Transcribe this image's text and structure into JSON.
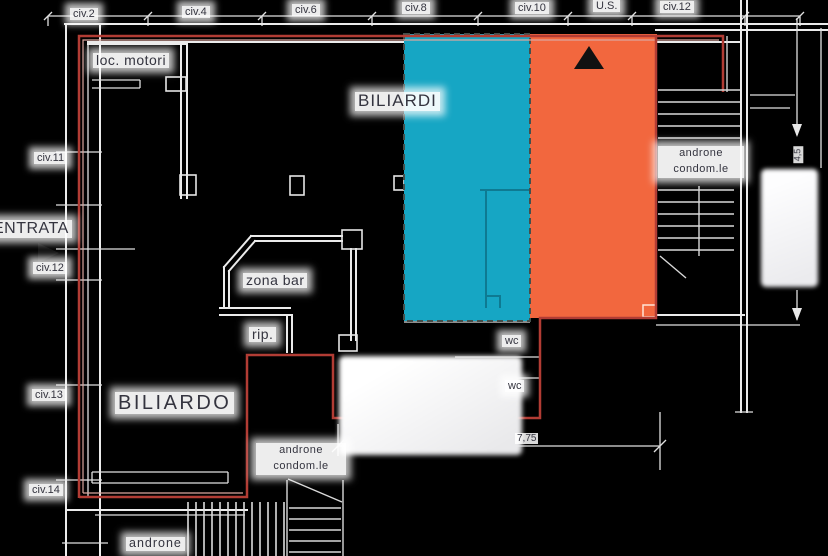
{
  "canvas": {
    "width": 828,
    "height": 556,
    "background": "#000000"
  },
  "colors": {
    "teal": "#16a6c4",
    "orange": "#f2673e",
    "outline_red": "#b23c34",
    "plan_line": "#ebebeb",
    "label_text": "#34343f",
    "label_halo": "#ffffff"
  },
  "labels": {
    "civ2": "civ.2",
    "civ4": "civ.4",
    "civ6": "civ.6",
    "civ8": "civ.8",
    "civ10": "civ.10",
    "us": "U.S.",
    "civ12_top": "civ.12",
    "civ11": "civ.11",
    "entrata": "ENTRATA",
    "civ12_left": "civ.12",
    "civ13": "civ.13",
    "civ14": "civ.14",
    "loc_motori": "loc. motori",
    "biliardi": "BILIARDI",
    "zona_bar": "zona bar",
    "rip": "rip.",
    "biliardo": "BILIARDO",
    "wc_upper": "wc",
    "wc_lower": "wc",
    "androne_right": {
      "line1": "androne",
      "line2": "condom.le"
    },
    "androne_bottom_area": {
      "line1": "androne",
      "line2": "condom.le"
    },
    "androne_bottom": "androne",
    "dim_width": "7,75",
    "dim_height": "4,5"
  },
  "markers": {
    "exit_triangle": "black-up-triangle",
    "entrance_triangle": "black-right-triangle"
  }
}
